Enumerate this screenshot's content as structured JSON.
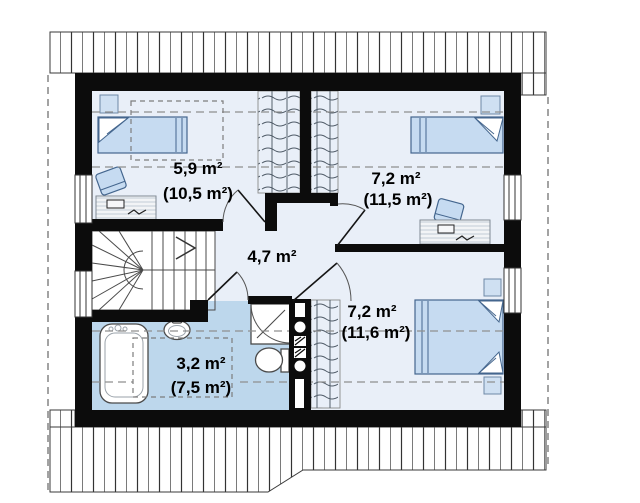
{
  "floor_plan": {
    "title": "attic-floor-plan",
    "rooms": [
      {
        "id": "bedroom-top-left",
        "area": "5,9 m²",
        "floor_area": "(10,5 m²)"
      },
      {
        "id": "bedroom-top-right",
        "area": "7,2 m²",
        "floor_area": "(11,5 m²)"
      },
      {
        "id": "hall",
        "area": "4,7 m²"
      },
      {
        "id": "bedroom-bottom-right",
        "area": "7,2 m²",
        "floor_area": "(11,6 m²)"
      },
      {
        "id": "bathroom",
        "area": "3,2 m²",
        "floor_area": "(7,5 m²)"
      }
    ],
    "colors": {
      "wall": "#0c0c0c",
      "room_floor": "#e9eff8",
      "bathroom_floor": "#bdd7ec",
      "furniture_fill": "#c6dbf1",
      "furniture_stroke": "#44668e",
      "label_text": "#000000"
    }
  }
}
